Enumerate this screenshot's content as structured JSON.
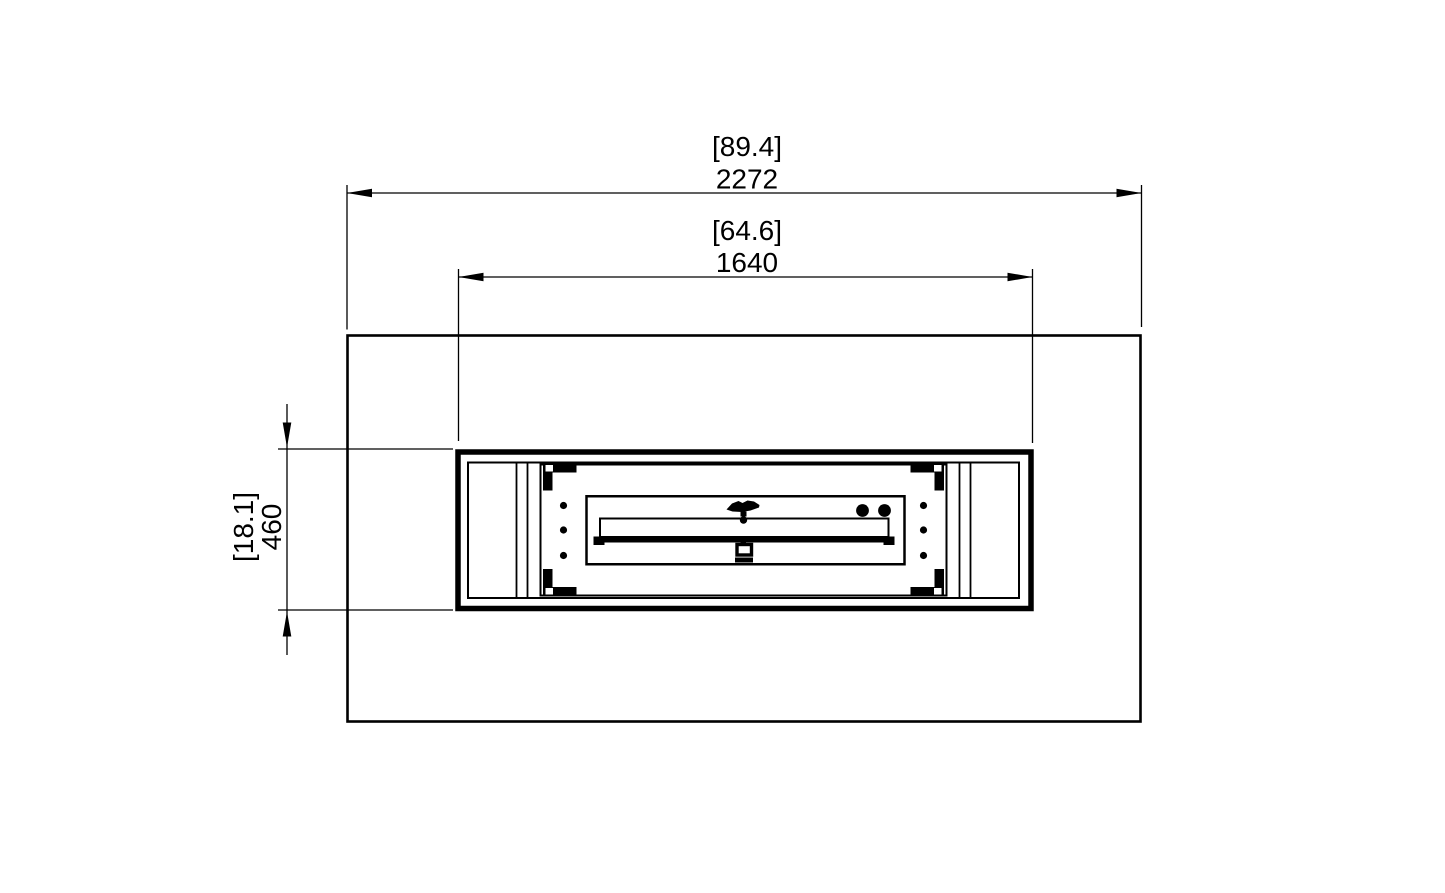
{
  "drawing": {
    "colors": {
      "line": "#000000",
      "background": "#ffffff"
    },
    "dimensions": {
      "overall_width": {
        "imperial": "[89.4]",
        "metric": "2272"
      },
      "burner_box_width": {
        "imperial": "[64.6]",
        "metric": "1640"
      },
      "burner_box_depth": {
        "imperial": "[18.1]",
        "metric": "460"
      }
    }
  }
}
